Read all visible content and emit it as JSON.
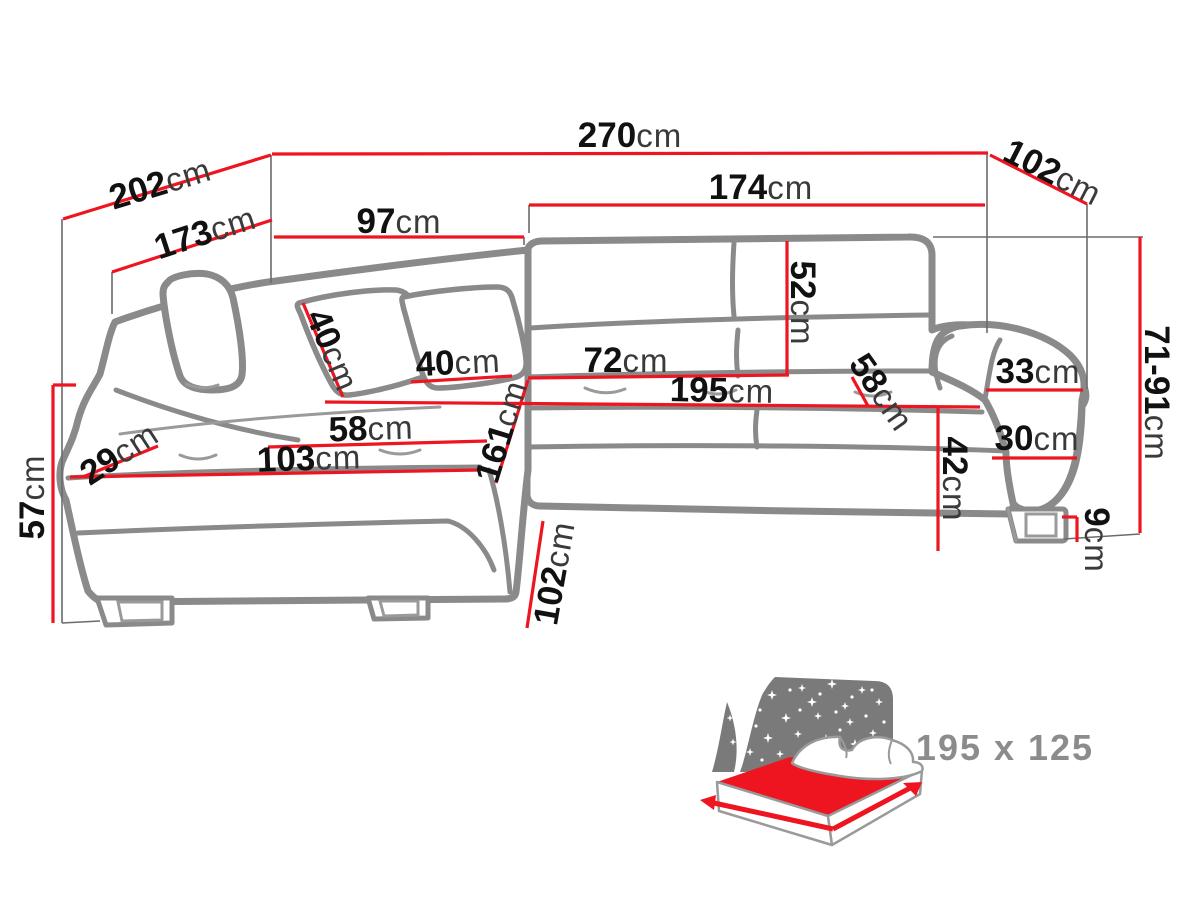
{
  "diagram": {
    "title_hint": "corner sofa dimension drawing",
    "colors": {
      "dimension_red": "#ee1520",
      "sofa_outline_gray": "#8a8a8a",
      "reference_line_gray": "#6b6b6b",
      "label_number_black": "#111111",
      "label_unit_gray": "#3a3a3a",
      "inset_bed_gray": "#7a7a7a",
      "inset_label_gray": "#8c8c8c"
    },
    "dimensions": [
      {
        "value": "270",
        "unit": "cm"
      },
      {
        "value": "202",
        "unit": "cm"
      },
      {
        "value": "102",
        "unit": "cm"
      },
      {
        "value": "173",
        "unit": "cm"
      },
      {
        "value": "97",
        "unit": "cm"
      },
      {
        "value": "174",
        "unit": "cm"
      },
      {
        "value": "52",
        "unit": "cm"
      },
      {
        "value": "40",
        "unit": "cm"
      },
      {
        "value": "40",
        "unit": "cm"
      },
      {
        "value": "72",
        "unit": "cm"
      },
      {
        "value": "195",
        "unit": "cm"
      },
      {
        "value": "58",
        "unit": "cm"
      },
      {
        "value": "33",
        "unit": "cm"
      },
      {
        "value": "30",
        "unit": "cm"
      },
      {
        "value": "42",
        "unit": "cm"
      },
      {
        "value": "71-91",
        "unit": "cm"
      },
      {
        "value": "9",
        "unit": "cm"
      },
      {
        "value": "57",
        "unit": "cm"
      },
      {
        "value": "29",
        "unit": "cm"
      },
      {
        "value": "58",
        "unit": "cm"
      },
      {
        "value": "103",
        "unit": "cm"
      },
      {
        "value": "161",
        "unit": "cm"
      },
      {
        "value": "102",
        "unit": "cm"
      }
    ],
    "inset": {
      "sleeping_area_label": "195 x 125"
    }
  }
}
